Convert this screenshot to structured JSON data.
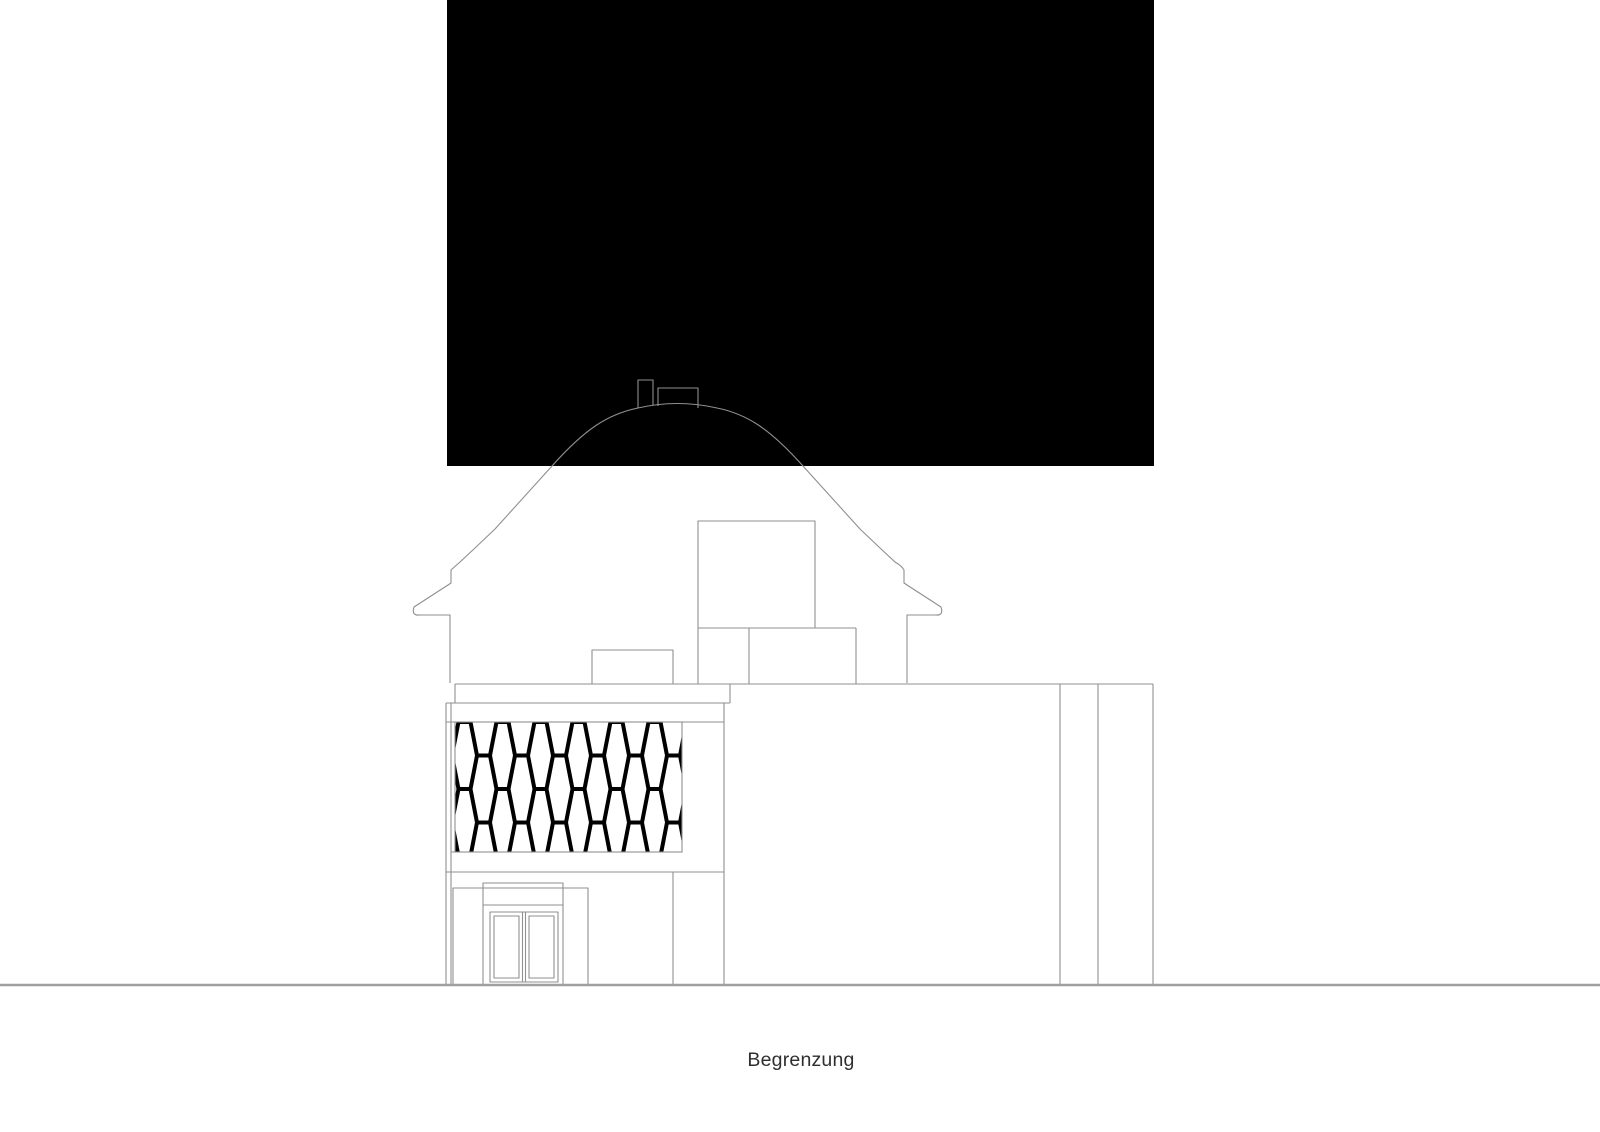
{
  "caption": {
    "label": "Begrenzung"
  },
  "colors": {
    "background": "#ffffff",
    "mask": "#000000",
    "line": "#8f8f8f",
    "line_on_black": "#8f8f8f",
    "pattern": "#000000",
    "ground": "#a0a0a0",
    "text": "#2f2f2f"
  }
}
